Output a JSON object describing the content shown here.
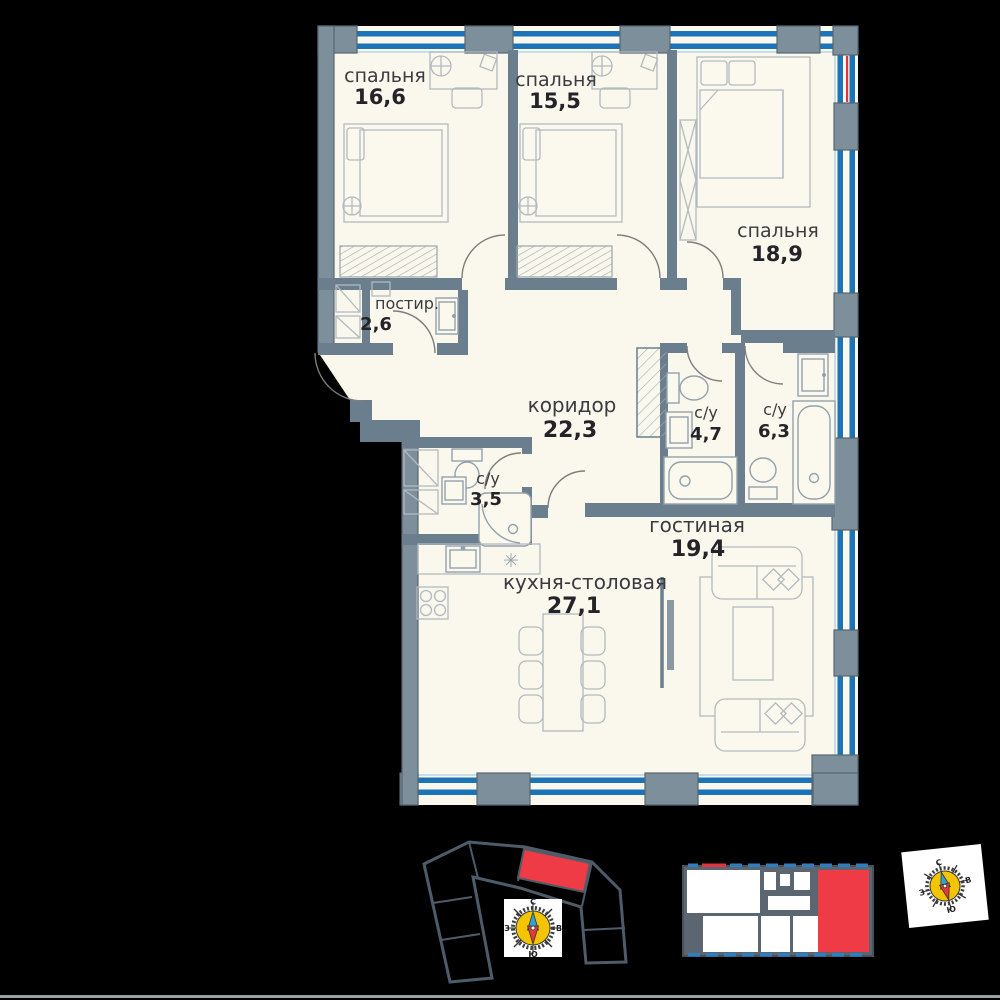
{
  "plan": {
    "rooms": {
      "bedroom1": {
        "label": "спальня",
        "area": "16,6"
      },
      "bedroom2": {
        "label": "спальня",
        "area": "15,5"
      },
      "bedroom3": {
        "label": "спальня",
        "area": "18,9"
      },
      "laundry": {
        "label": "постир.",
        "area": "2,6"
      },
      "corridor": {
        "label": "коридор",
        "area": "22,3"
      },
      "bath1": {
        "label": "с/у",
        "area": "4,7"
      },
      "bath2": {
        "label": "с/у",
        "area": "6,3"
      },
      "bath3": {
        "label": "с/у",
        "area": "3,5"
      },
      "living": {
        "label": "гостиная",
        "area": "19,4"
      },
      "kitchen": {
        "label": "кухня-столовая",
        "area": "27,1"
      }
    }
  },
  "compass": {
    "north": "С",
    "south": "Ю",
    "west": "З",
    "east": "В"
  },
  "symbols": {
    "burner": "✳"
  },
  "colors": {
    "background": "#000000",
    "floor": "#FAF8EC",
    "wall": "#6B7E8E",
    "window_blue": "#1B74B8",
    "highlight_red": "#EE3B46",
    "compass_yellow": "#F2C500"
  }
}
